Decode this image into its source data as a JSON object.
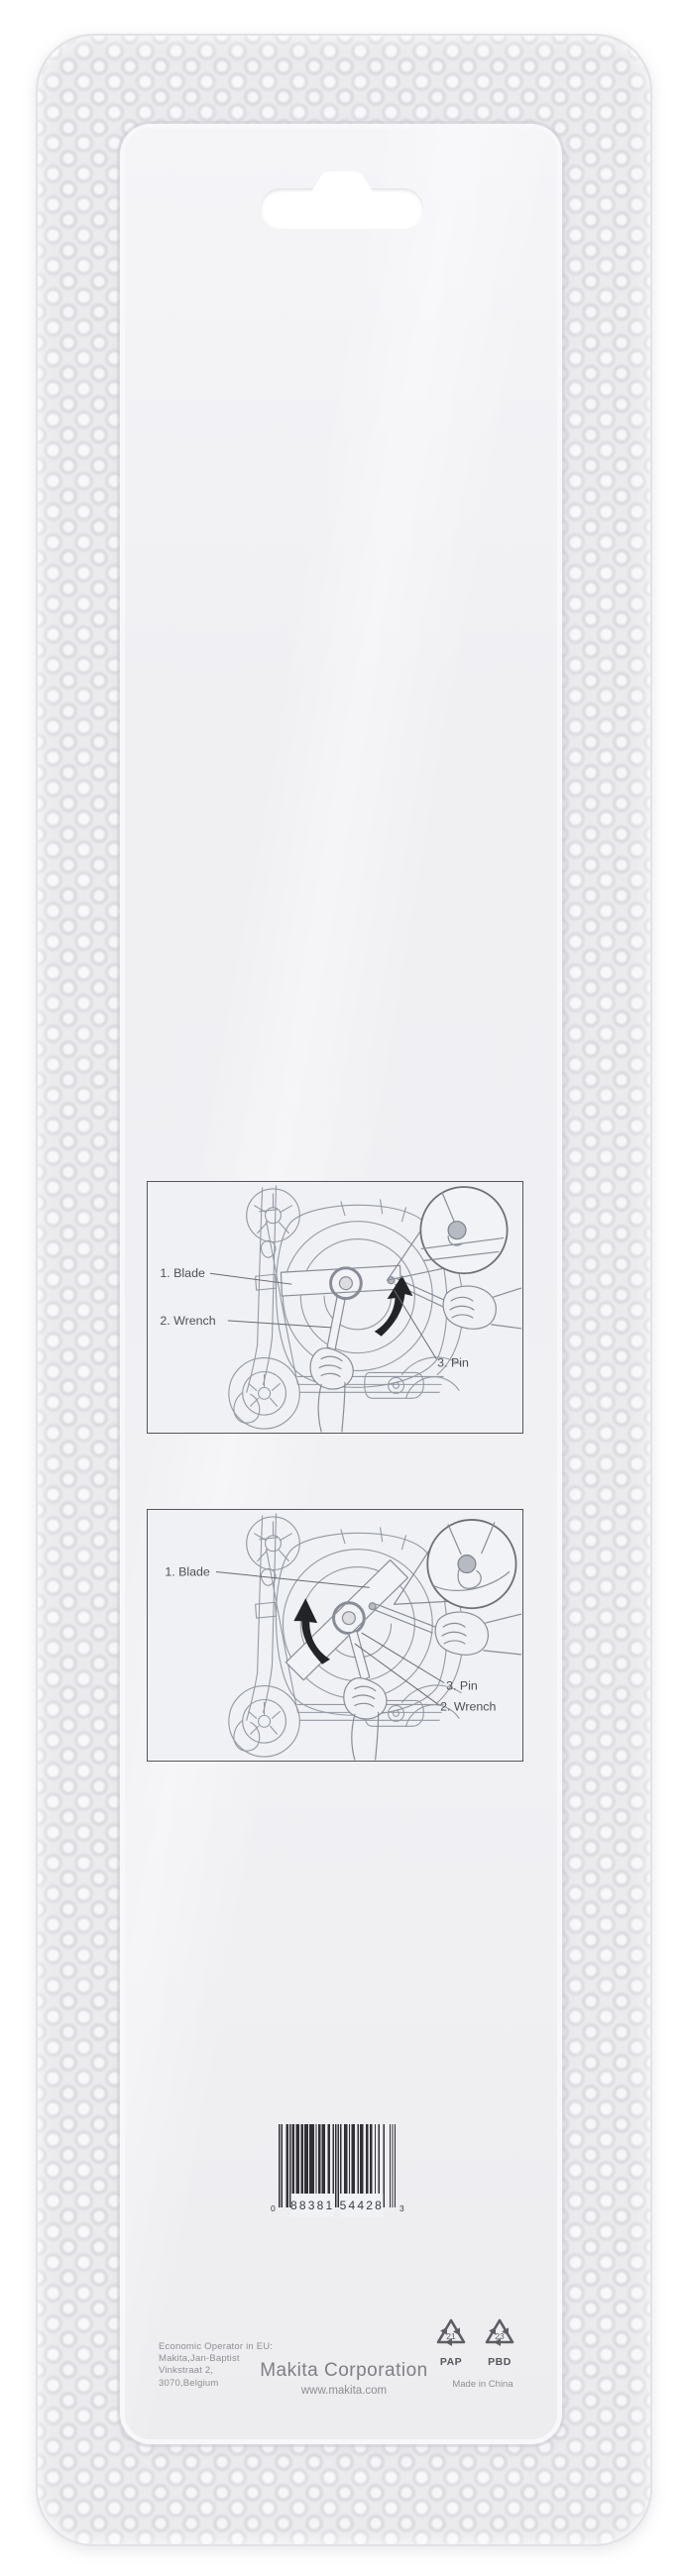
{
  "package": {
    "diagrams": [
      {
        "labels": {
          "blade": "1. Blade",
          "wrench": "2. Wrench",
          "pin": "3. Pin"
        }
      },
      {
        "labels": {
          "blade": "1. Blade",
          "pin": "3. Pin",
          "wrench": "2. Wrench"
        }
      }
    ],
    "barcode": {
      "code": "088381544283",
      "system_digit": "0",
      "left_group": "88381",
      "right_group": "54428",
      "check_digit": "3"
    },
    "footer": {
      "eu_operator_line1": "Economic Operator in EU:",
      "eu_operator_line2": "Makita,Jan-Baptist",
      "eu_operator_line3": "Vinkstraat 2,",
      "eu_operator_line4": "3070,Belgium",
      "corporation": "Makita Corporation",
      "website": "www.makita.com",
      "recycling_1_code": "21",
      "recycling_1_label": "PAP",
      "recycling_2_code": "23",
      "recycling_2_label": "PBD",
      "made_in": "Made in China"
    },
    "colors": {
      "card": "#f1f1f4",
      "blister": "#ececef",
      "line_art": "#9299a3",
      "label_text": "#4f5056",
      "arrow": "#232428",
      "footer_text": "#8e8f95",
      "barcode_bars": "#303036"
    }
  }
}
